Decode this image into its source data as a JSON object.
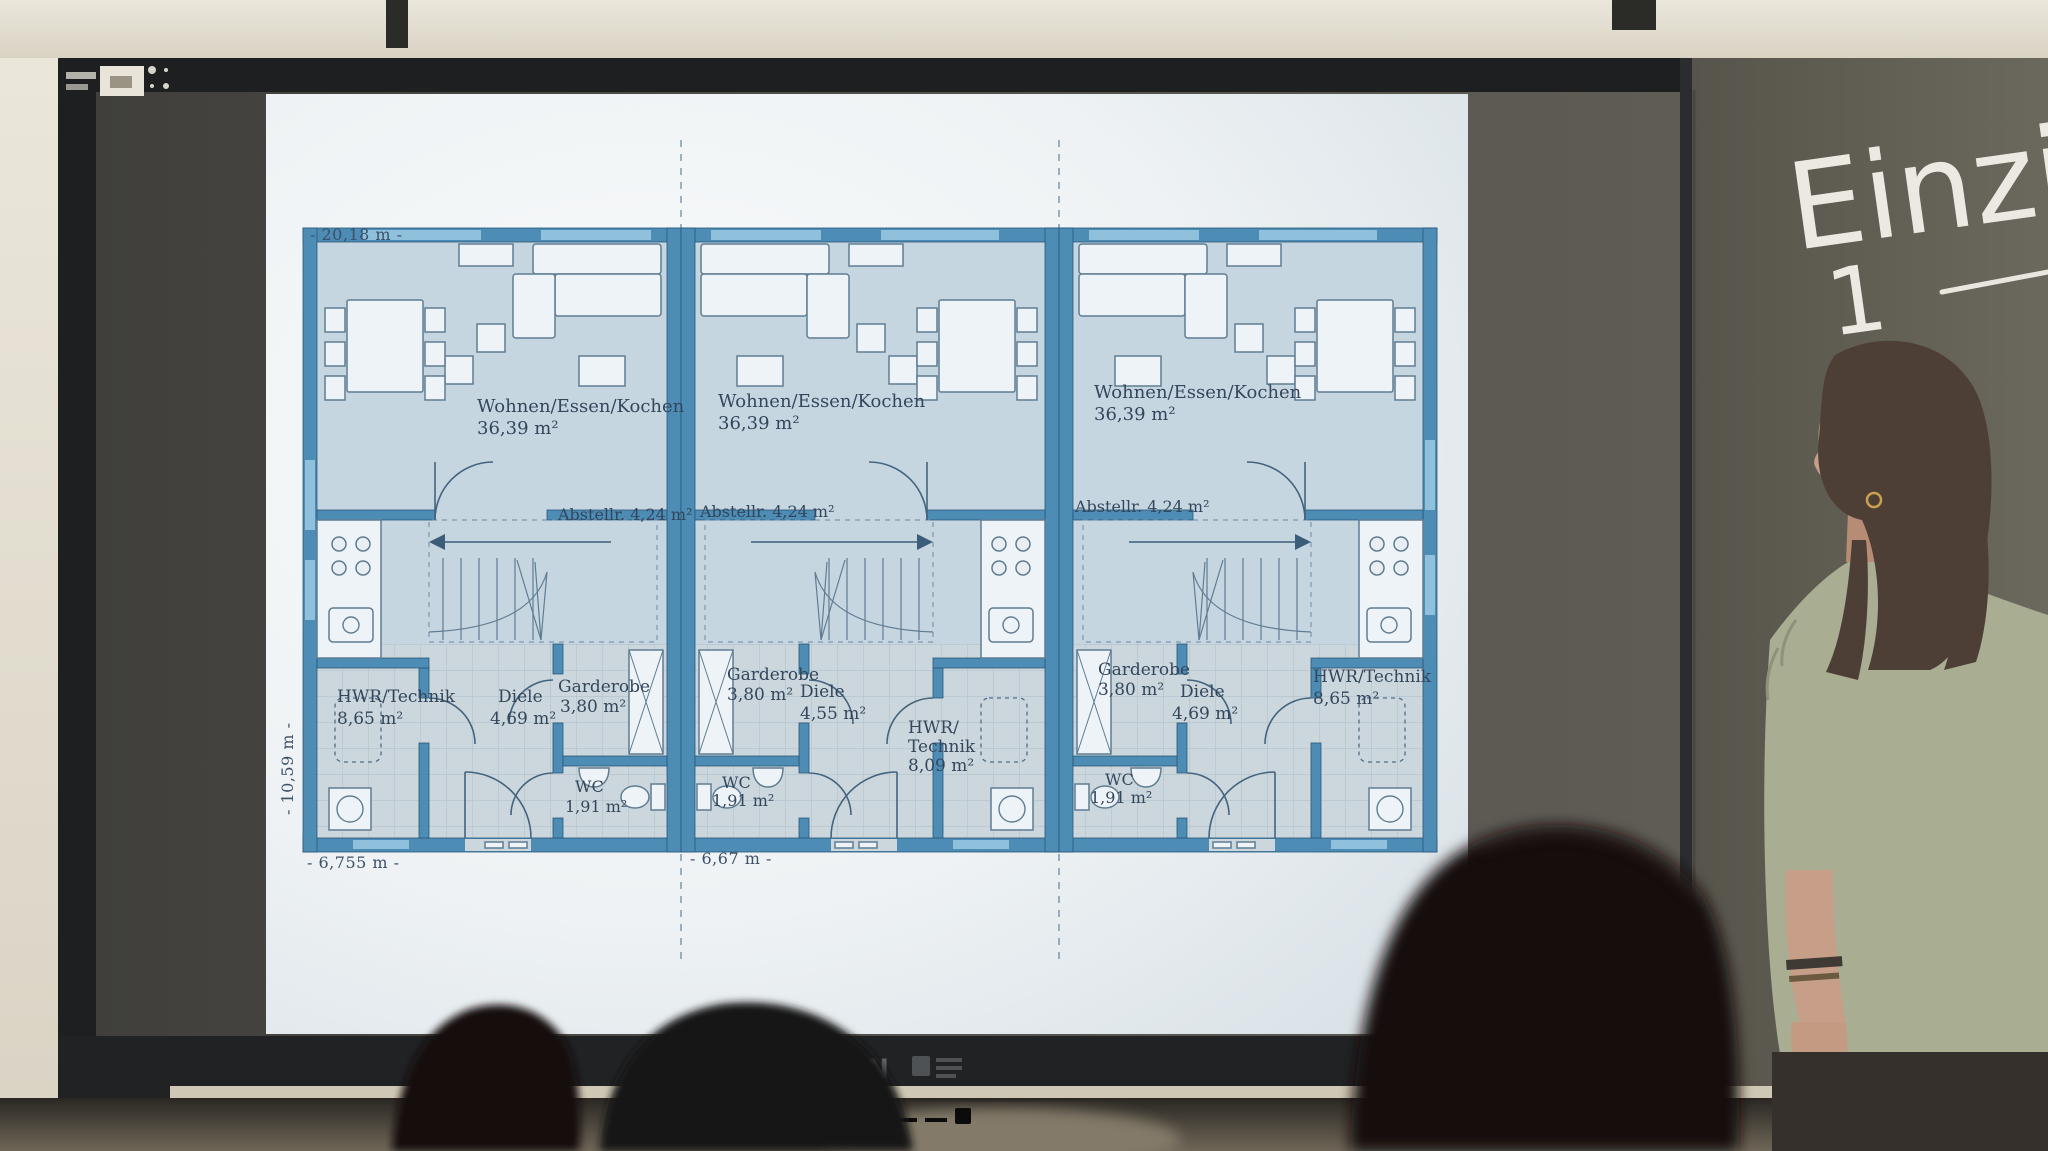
{
  "board": {
    "chalk_word": "Einzim",
    "chalk_number": "1"
  },
  "display": {
    "brand": "ODIN"
  },
  "floor_plan": {
    "dimensions": {
      "total_width": "- 20,18 m -",
      "total_depth": "- 10,59 m -",
      "unit_left_width": "- 6,755 m -",
      "unit_middle_width": "- 6,67 m -"
    },
    "units": [
      {
        "living1": "Wohnen/Essen/Kochen",
        "living2": "36,39 m²",
        "storage": "Abstellr. 4,24 m²",
        "utility1": "HWR/Technik",
        "utility2": "8,65 m²",
        "hall1": "Diele",
        "hall2": "4,69 m²",
        "wardrobe1": "Garderobe",
        "wardrobe2": "3,80 m²",
        "wc1": "WC",
        "wc2": "1,91 m²"
      },
      {
        "living1": "Wohnen/Essen/Kochen",
        "living2": "36,39 m²",
        "storage": "Abstellr. 4,24 m²",
        "utility1": "HWR/",
        "utility2": "Technik",
        "utility3": "8,09 m²",
        "hall1": "Diele",
        "hall2": "4,55 m²",
        "wardrobe1": "Garderobe",
        "wardrobe2": "3,80 m²",
        "wc1": "WC",
        "wc2": "1,91 m²"
      },
      {
        "living1": "Wohnen/Essen/Kochen",
        "living2": "36,39 m²",
        "storage": "Abstellr. 4,24 m²",
        "utility1": "HWR/Technik",
        "utility2": "8,65 m²",
        "hall1": "Diele",
        "hall2": "4,69 m²",
        "wardrobe1": "Garderobe",
        "wardrobe2": "3,80 m²",
        "wc1": "WC",
        "wc2": "1,91 m²"
      }
    ]
  },
  "colors": {
    "plan_wall_blue": "#4d8cb4",
    "plan_text": "#33465c",
    "chalk": "#ebe9e1",
    "blouse_sage": "#a9ad92"
  }
}
